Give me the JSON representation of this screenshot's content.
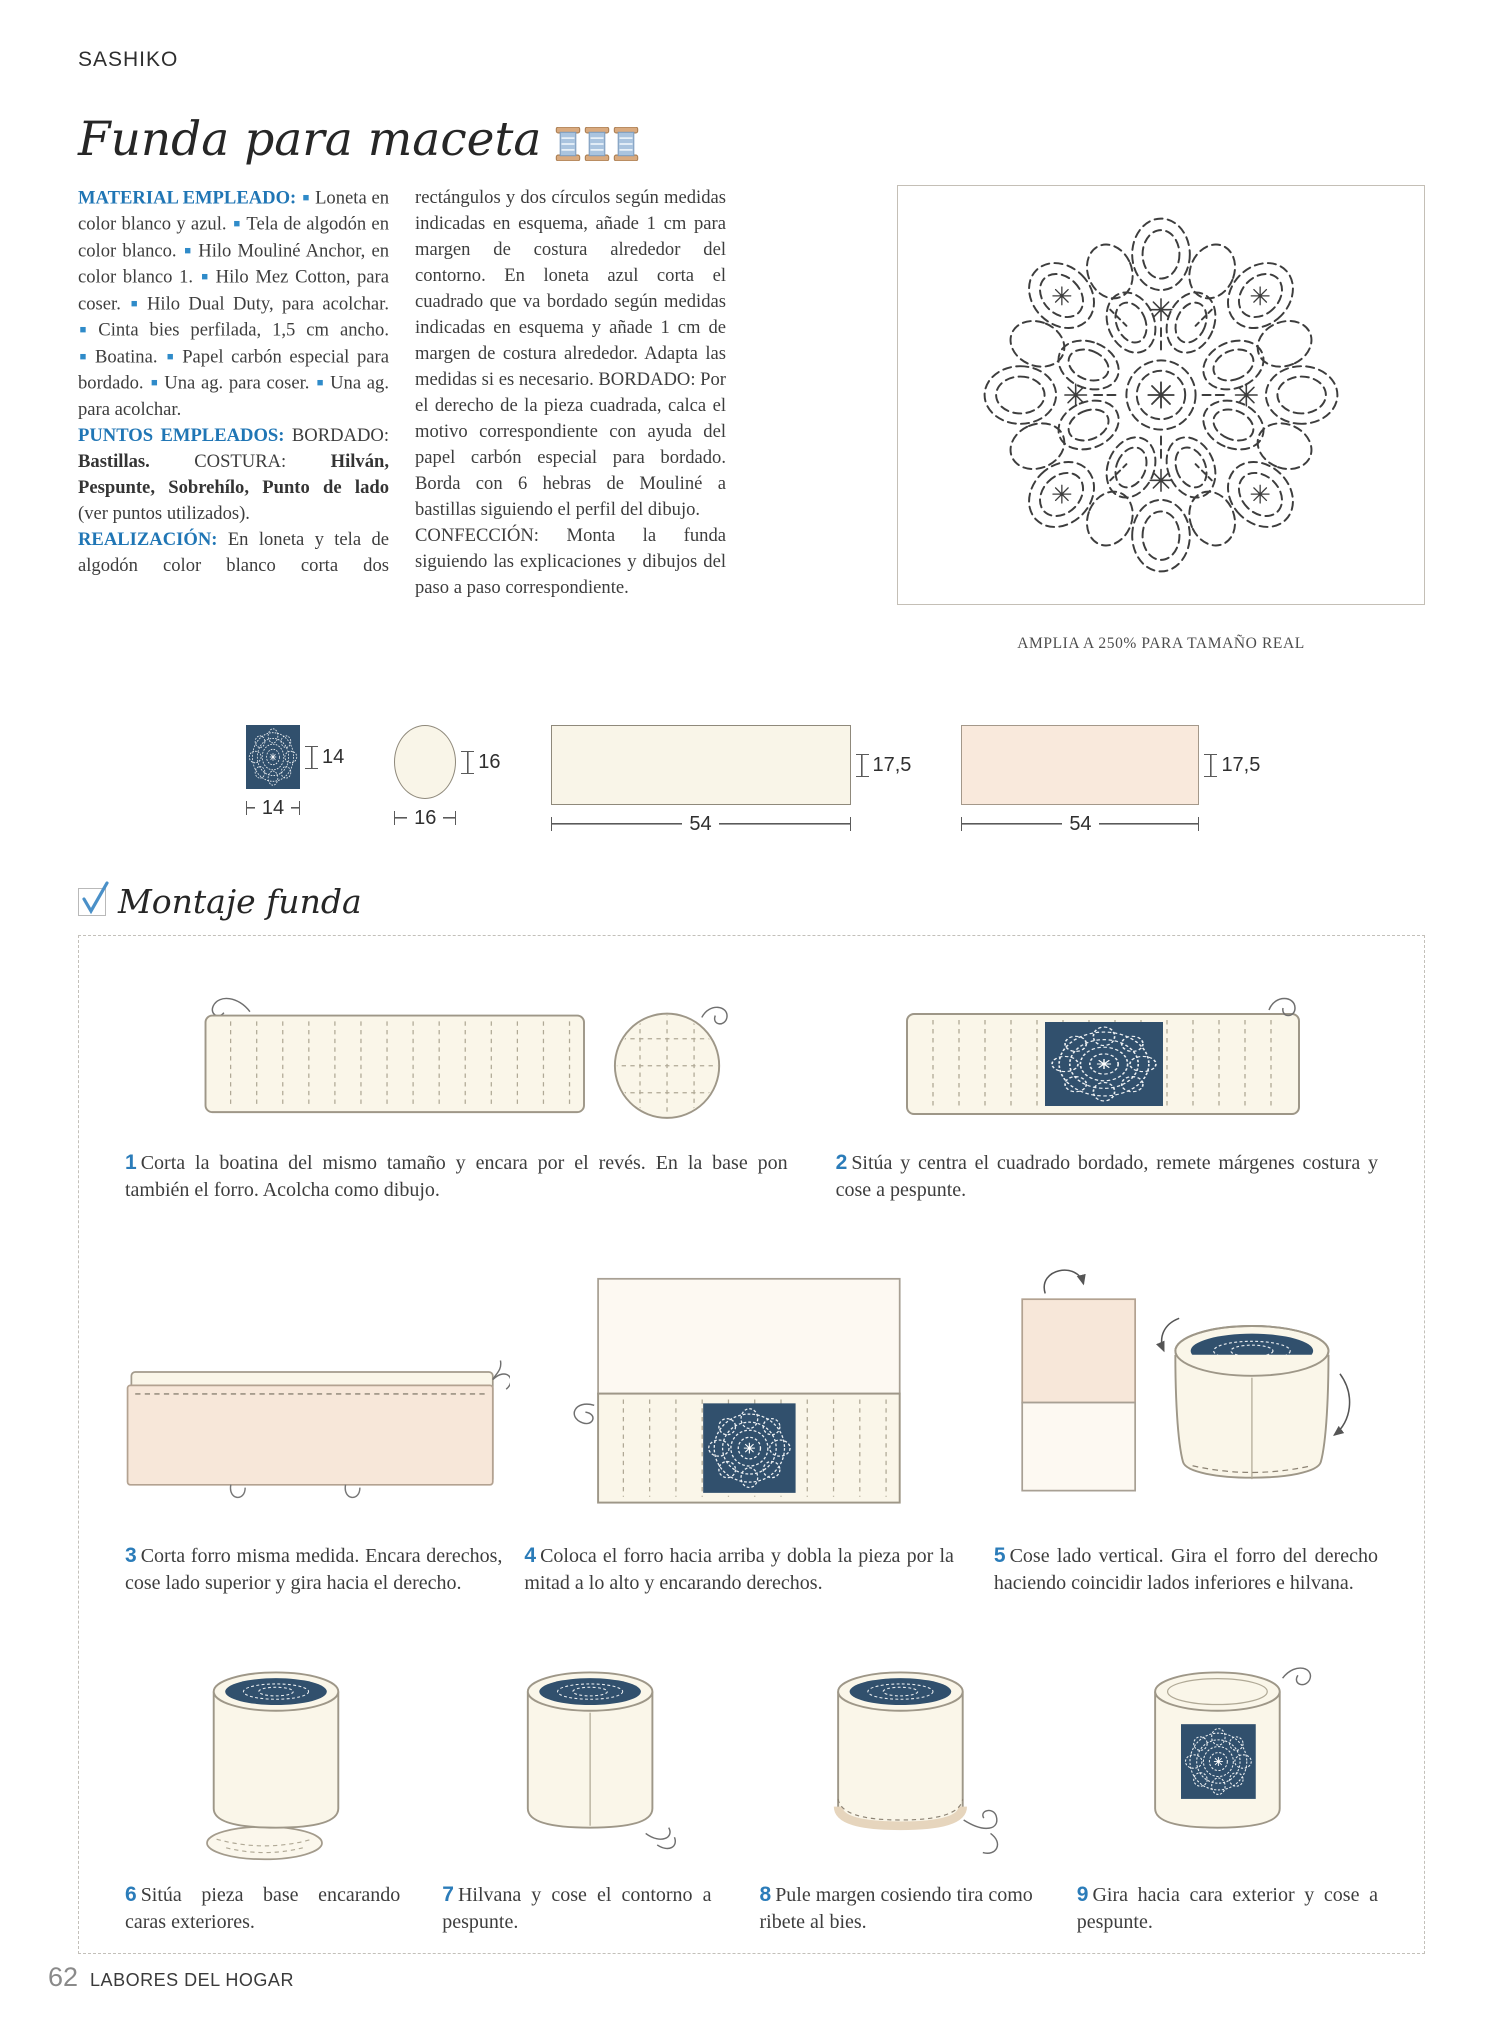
{
  "page": {
    "kicker": "SASHIKO",
    "title": "Funda para maceta",
    "pattern_caption": "AMPLIA A 250% PARA TAMAÑO REAL",
    "montaje_title": "Montaje funda",
    "footer": {
      "page_number": "62",
      "magazine": "LABORES DEL HOGAR"
    }
  },
  "colors": {
    "accent_blue": "#2b7cb9",
    "label_blue": "#2076b5",
    "navy_fabric": "#31506d",
    "cream_fabric": "#f9f5e8",
    "pink_fabric": "#f9e9dc"
  },
  "article": {
    "p1": [
      {
        "s": "label",
        "t": "MATERIAL EMPLEADO: "
      },
      {
        "s": "bullet"
      },
      {
        "s": "n",
        "t": "Loneta en color blanco y azul. "
      },
      {
        "s": "bullet"
      },
      {
        "s": "n",
        "t": "Tela de algodón en color blanco. "
      },
      {
        "s": "bullet"
      },
      {
        "s": "n",
        "t": "Hilo Mouliné Anchor, en color blanco 1. "
      },
      {
        "s": "bullet"
      },
      {
        "s": "n",
        "t": "Hilo Mez Cotton, para coser. "
      },
      {
        "s": "bullet"
      },
      {
        "s": "n",
        "t": "Hilo Dual Duty, para acolchar. "
      },
      {
        "s": "bullet"
      },
      {
        "s": "n",
        "t": "Cinta bies perfilada, 1,5 cm ancho. "
      },
      {
        "s": "bullet"
      },
      {
        "s": "n",
        "t": "Boatina. "
      },
      {
        "s": "bullet"
      },
      {
        "s": "n",
        "t": "Papel carbón especial para bordado. "
      },
      {
        "s": "bullet"
      },
      {
        "s": "n",
        "t": "Una ag. para coser. "
      },
      {
        "s": "bullet"
      },
      {
        "s": "n",
        "t": "Una ag. para acolchar."
      }
    ],
    "p2": [
      {
        "s": "label",
        "t": "PUNTOS EMPLEADOS: "
      },
      {
        "s": "n",
        "t": "BORDADO: "
      },
      {
        "s": "b",
        "t": "Bastillas. "
      },
      {
        "s": "n",
        "t": "COSTURA: "
      },
      {
        "s": "b",
        "t": "Hilván, Pespunte, Sobrehílo, Punto de lado "
      },
      {
        "s": "n",
        "t": "(ver puntos utilizados)."
      }
    ],
    "p3": [
      {
        "s": "label",
        "t": "REALIZACIÓN: "
      },
      {
        "s": "n",
        "t": "En loneta y tela de algodón color blanco corta dos rectángulos y dos círculos según medidas indicadas en esquema, añade 1 cm para margen de costura alrededor del contorno. En loneta azul corta el cuadrado que va bordado según medidas indicadas en esquema y añade 1 cm de margen de costura alrededor. Adapta las medidas si es necesario. BORDADO: Por el derecho de la pieza cuadrada, calca el motivo correspondiente con ayuda del papel carbón especial para bordado. Borda con 6 hebras de Mouliné a bastillas siguiendo el perfil del dibujo."
      }
    ],
    "p4": [
      {
        "s": "n",
        "t": "CONFECCIÓN: Monta la funda siguiendo las explicaciones y dibujos del paso a paso correspondiente."
      }
    ]
  },
  "schema": [
    {
      "shape": "navy-embroidered-square",
      "width": "14",
      "height": "14"
    },
    {
      "shape": "circle",
      "width": "16",
      "height": "16"
    },
    {
      "shape": "cream-rectangle",
      "width": "54",
      "height": "17,5"
    },
    {
      "shape": "pink-rectangle",
      "width": "54",
      "height": "17,5"
    }
  ],
  "steps": [
    {
      "num": "1",
      "text": "Corta la boatina del mismo tamaño y encara por el revés. En la base pon también el forro. Acolcha como dibujo."
    },
    {
      "num": "2",
      "text": "Sitúa y centra el cuadrado bordado, remete márgenes costura y cose a pespunte."
    },
    {
      "num": "3",
      "text": "Corta forro misma medida. Encara derechos, cose lado superior y gira hacia el derecho."
    },
    {
      "num": "4",
      "text": "Coloca el forro hacia arriba y dobla la pieza por la mitad a lo alto y encarando derechos."
    },
    {
      "num": "5",
      "text": "Cose lado vertical. Gira el forro del derecho haciendo coincidir lados inferiores e hilvana."
    },
    {
      "num": "6",
      "text": "Sitúa pieza base encarando caras exteriores."
    },
    {
      "num": "7",
      "text": "Hilvana y cose el contorno a pespunte."
    },
    {
      "num": "8",
      "text": "Pule margen cosiendo tira como ribete al bies."
    },
    {
      "num": "9",
      "text": "Gira hacia cara exterior y cose a pespunte."
    }
  ]
}
